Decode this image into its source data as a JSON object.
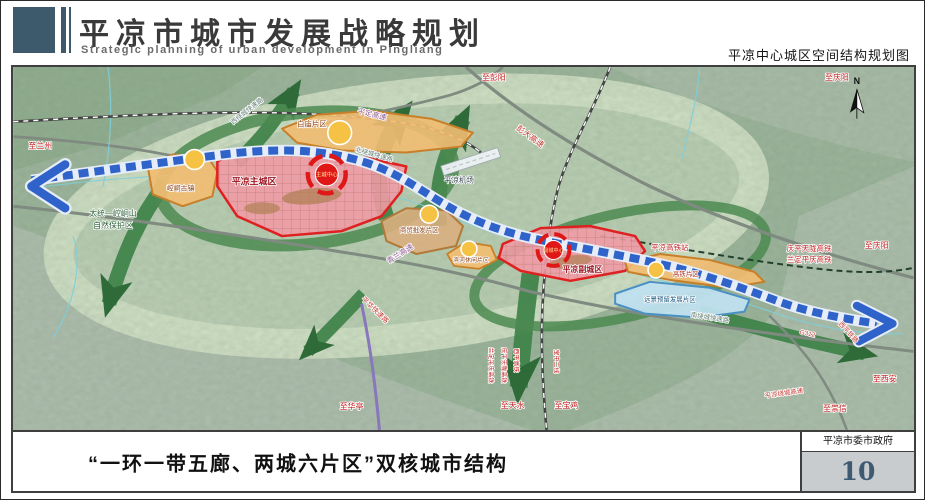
{
  "header": {
    "title_cn": "平凉市城市发展战略规划",
    "title_en": "Strategic planning of urban development in Pingliang",
    "subtitle_right": "平凉中心城区空间结构规划图"
  },
  "footer": {
    "caption": "“一环一带五廊、两城六片区”双核城市结构",
    "org": "平凉市委市政府",
    "page_number": "10"
  },
  "colors": {
    "header_accent": "#3c5a6c",
    "zone_city_fill": "#f09ba5",
    "zone_city_border": "#e02020",
    "zone_orange_fill": "#f2bd72",
    "zone_orange_border": "#c87f2a",
    "zone_blue_fill": "#bfe0ee",
    "corridor_green": "#3e8148",
    "belt_blue": "#2f63c9",
    "node_yellow": "#f6c243",
    "center_red": "#e01717"
  },
  "map": {
    "compass_label": "N",
    "labels": [
      {
        "name": "to-lanzhou",
        "text": "至兰州",
        "x": 27,
        "y": 82,
        "size": 8,
        "color": "#c21f1f"
      },
      {
        "name": "nature-reserve-1",
        "text": "太统—崆峒山",
        "x": 100,
        "y": 150,
        "size": 8,
        "color": "#265c33"
      },
      {
        "name": "nature-reserve-2",
        "text": "自然保护区",
        "x": 100,
        "y": 162,
        "size": 8,
        "color": "#265c33"
      },
      {
        "name": "zone-kongtong-town",
        "text": "崆峒古镇",
        "x": 168,
        "y": 124,
        "size": 7,
        "color": "#8a4012"
      },
      {
        "name": "zone-baimiao",
        "text": "白庙片区",
        "x": 300,
        "y": 60,
        "size": 7.5,
        "color": "#8a4012"
      },
      {
        "name": "zone-main-city",
        "text": "平凉主城区",
        "x": 242,
        "y": 118,
        "size": 9,
        "color": "#9c1420",
        "bold": true
      },
      {
        "name": "main-center",
        "text": "主城中心",
        "x": 315,
        "y": 110,
        "size": 5.5,
        "color": "#ffe096",
        "halo": false
      },
      {
        "name": "zone-wholesale",
        "text": "商贸批发片区",
        "x": 408,
        "y": 166,
        "size": 6.5,
        "color": "#8a4012"
      },
      {
        "name": "zone-leisure",
        "text": "滨河休闲片区",
        "x": 460,
        "y": 196,
        "size": 6,
        "color": "#8a4012"
      },
      {
        "name": "zone-sub-city",
        "text": "平凉副城区",
        "x": 572,
        "y": 206,
        "size": 8,
        "color": "#9c1420",
        "bold": true
      },
      {
        "name": "sub-center",
        "text": "副城中心",
        "x": 543,
        "y": 186,
        "size": 5,
        "color": "#ffe096",
        "halo": false
      },
      {
        "name": "zone-hsr",
        "text": "高铁片区",
        "x": 676,
        "y": 210,
        "size": 6.5,
        "color": "#b03018"
      },
      {
        "name": "zone-reserved",
        "text": "远景预留发展片区",
        "x": 660,
        "y": 236,
        "size": 6.5,
        "color": "#17547e"
      },
      {
        "name": "airport",
        "text": "平凉机场",
        "x": 448,
        "y": 116,
        "size": 7.5,
        "color": "#33424e"
      },
      {
        "name": "hsr-station",
        "text": "平凉高铁站",
        "x": 660,
        "y": 184,
        "size": 7.5,
        "color": "#c21f1f"
      },
      {
        "name": "hsr-line-1",
        "text": "庆平天陇高铁",
        "x": 800,
        "y": 185,
        "size": 7.5,
        "color": "#c21f1f"
      },
      {
        "name": "hsr-line-2",
        "text": "兰定平庆高铁",
        "x": 800,
        "y": 196,
        "size": 7.5,
        "color": "#c21f1f"
      },
      {
        "name": "to-pengyang",
        "text": "至彭阳",
        "x": 483,
        "y": 13,
        "size": 8,
        "color": "#c21f1f"
      },
      {
        "name": "to-qingyang-top",
        "text": "至庆阳",
        "x": 828,
        "y": 13,
        "size": 8,
        "color": "#c21f1f"
      },
      {
        "name": "to-qingyang-right",
        "text": "至庆阳",
        "x": 868,
        "y": 182,
        "size": 8,
        "color": "#c21f1f"
      },
      {
        "name": "to-xian",
        "text": "至西安",
        "x": 876,
        "y": 316,
        "size": 8,
        "color": "#c21f1f"
      },
      {
        "name": "to-chongxin",
        "text": "至崇信",
        "x": 826,
        "y": 346,
        "size": 8,
        "color": "#c21f1f"
      },
      {
        "name": "to-huating",
        "text": "至华亭",
        "x": 340,
        "y": 344,
        "size": 8,
        "color": "#c21f1f"
      },
      {
        "name": "to-tianshui",
        "text": "至天水",
        "x": 502,
        "y": 343,
        "size": 8,
        "color": "#c21f1f"
      },
      {
        "name": "to-baoji",
        "text": "至宝鸡",
        "x": 556,
        "y": 343,
        "size": 8,
        "color": "#c21f1f"
      },
      {
        "name": "expwy-pengda",
        "text": "彭大高速",
        "x": 518,
        "y": 72,
        "rot": 36,
        "size": 8,
        "color": "#c03a30"
      },
      {
        "name": "expwy-pingding",
        "text": "平定高速",
        "x": 360,
        "y": 50,
        "rot": 14,
        "size": 7.5,
        "color": "#8e5a8e"
      },
      {
        "name": "ring-west",
        "text": "西绕城快速路",
        "x": 236,
        "y": 46,
        "rot": -38,
        "size": 6.5,
        "color": "#5f7d72"
      },
      {
        "name": "ring-north",
        "text": "北绕城快速路",
        "x": 362,
        "y": 90,
        "rot": 16,
        "size": 6.5,
        "color": "#5f7d72"
      },
      {
        "name": "ring-south",
        "text": "南绕城快速路",
        "x": 700,
        "y": 254,
        "rot": 9,
        "size": 6.5,
        "color": "#5f7d72"
      },
      {
        "name": "expwy-qinglan",
        "text": "青兰高速",
        "x": 390,
        "y": 190,
        "rot": -32,
        "size": 7.5,
        "color": "#8e5a8e"
      },
      {
        "name": "expwy-pinghua",
        "text": "平华快速路",
        "x": 362,
        "y": 246,
        "rot": 44,
        "size": 7,
        "color": "#c03a30"
      },
      {
        "name": "road-g312",
        "text": "G312",
        "x": 798,
        "y": 270,
        "rot": 12,
        "size": 6.5,
        "color": "#c03a30"
      },
      {
        "name": "rail-xiping",
        "text": "西平铁路",
        "x": 838,
        "y": 268,
        "rot": 48,
        "size": 6.5,
        "color": "#c03a30"
      },
      {
        "name": "expwy-pl-ring",
        "text": "平凉绕城高速",
        "x": 775,
        "y": 330,
        "rot": -8,
        "size": 6.5,
        "color": "#c03a30"
      },
      {
        "name": "rail-landing-v",
        "text": "兰定平庆高铁",
        "x": 478,
        "y": 300,
        "rot": 90,
        "size": 6,
        "color": "#c21f1f"
      },
      {
        "name": "rail-qingping-v",
        "text": "庆平天陇高铁",
        "x": 491,
        "y": 300,
        "rot": 90,
        "size": 6,
        "color": "#c21f1f"
      },
      {
        "name": "rail-xiping-v",
        "text": "西平高铁",
        "x": 504,
        "y": 295,
        "rot": 90,
        "size": 6,
        "color": "#c21f1f"
      },
      {
        "name": "rail-baozhong-v",
        "text": "宝中二线",
        "x": 544,
        "y": 296,
        "rot": 90,
        "size": 6,
        "color": "#c21f1f"
      }
    ]
  }
}
